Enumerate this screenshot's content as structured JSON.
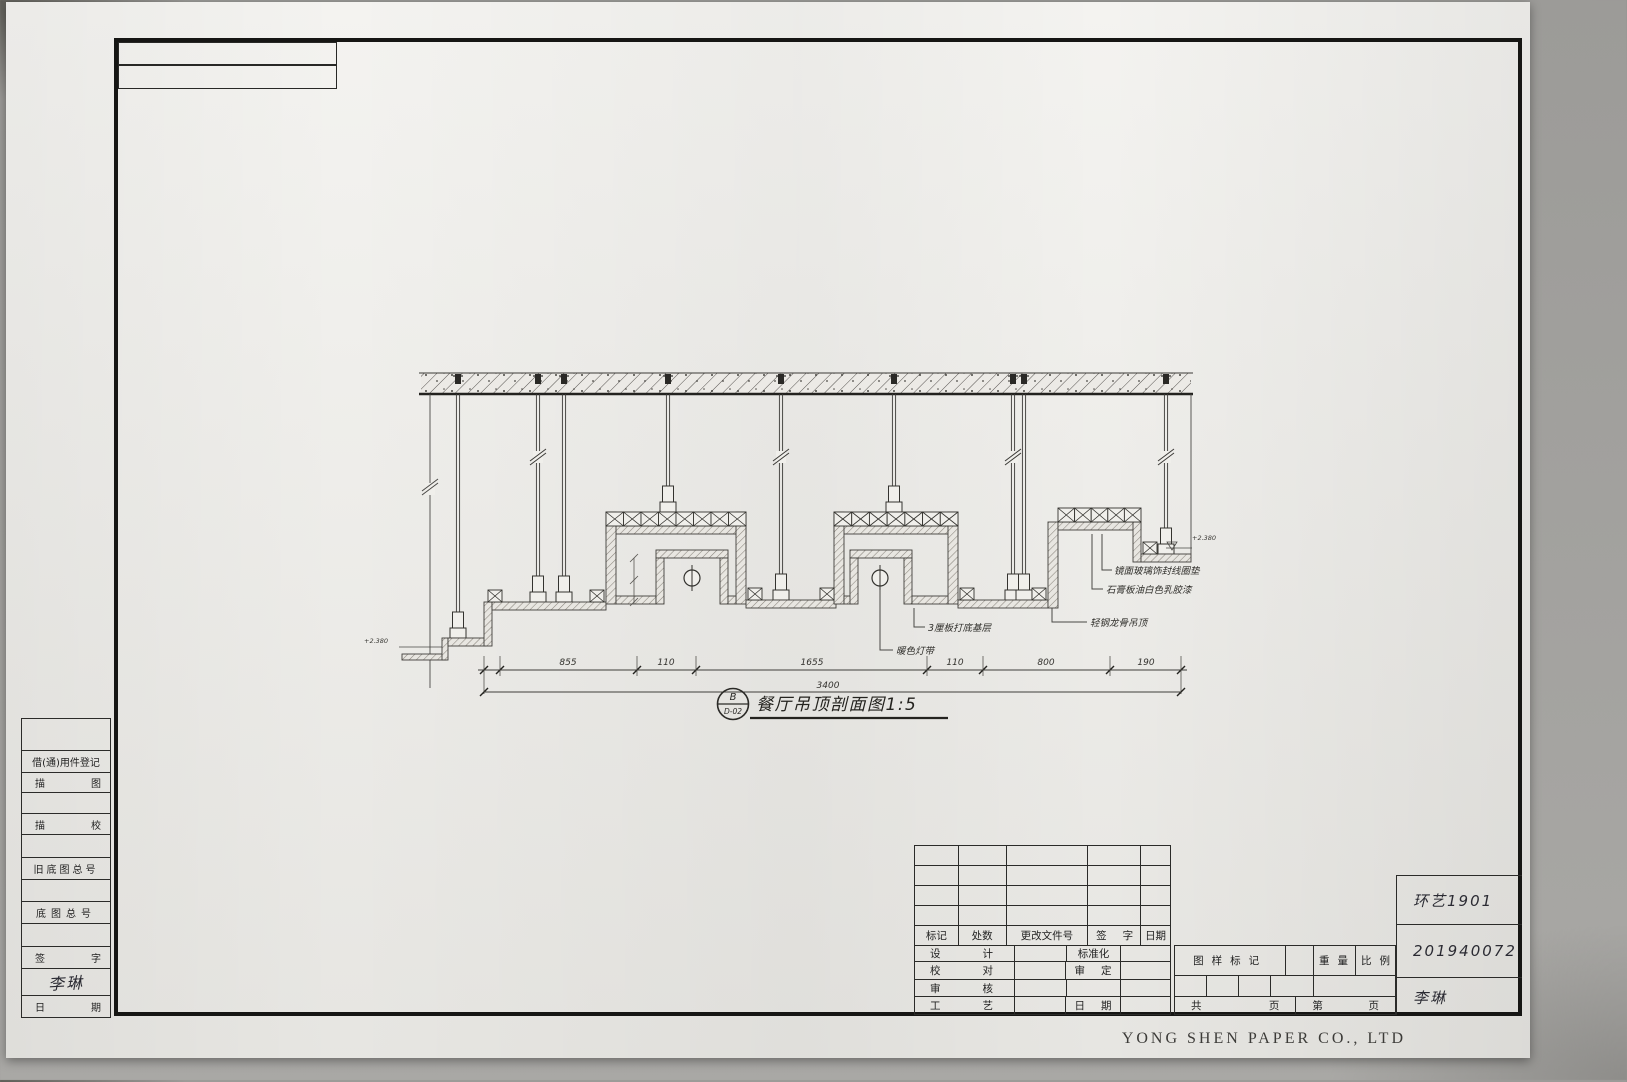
{
  "sheet": {
    "company": "YONG SHEN PAPER CO., LTD"
  },
  "drawing": {
    "title": "餐厅吊顶剖面图1:5",
    "detail_tag": {
      "letter": "B",
      "sheet_no": "D-02"
    },
    "levels": {
      "left": "+2.380",
      "right": "+2.380"
    },
    "annotations": {
      "mirror_glass": "镜面玻璃饰封线圈垫",
      "gypsum_paint": "石膏板油白色乳胶漆",
      "base_board": "3厘板打底基层",
      "light_strip": "暖色灯带",
      "steel_keel": "轻钢龙骨吊顶"
    },
    "dims": {
      "s0": "855",
      "s1": "110",
      "s2": "1655",
      "s3": "110",
      "s4": "800",
      "s5": "190",
      "total": "3400"
    }
  },
  "left_panel": {
    "borrow_record": "借(通)用件登记",
    "trace_draw": "描图",
    "trace_check": "描校",
    "old_base_no": "旧底图总号",
    "base_no": "底图总号",
    "sign": "签字",
    "date": "日期",
    "signature": "李琳"
  },
  "title_block": {
    "rev": {
      "mark": "标记",
      "count": "处数",
      "file_no": "更改文件号",
      "sign": "签字",
      "date": "日期"
    },
    "staff": {
      "design": "设计",
      "standardize": "标准化",
      "proofread": "校对",
      "approve": "审定",
      "review": "审核",
      "craft": "工艺",
      "date": "日期"
    },
    "mark_label": "图样标记",
    "weight_label": "重量",
    "scale_label": "比例",
    "pages": {
      "total_prefix": "共",
      "total_suffix": "页",
      "index_prefix": "第",
      "index_suffix": "页"
    }
  },
  "handwritten": {
    "class_name": "环艺1901",
    "student_id": "201940072",
    "name": "李琳"
  }
}
